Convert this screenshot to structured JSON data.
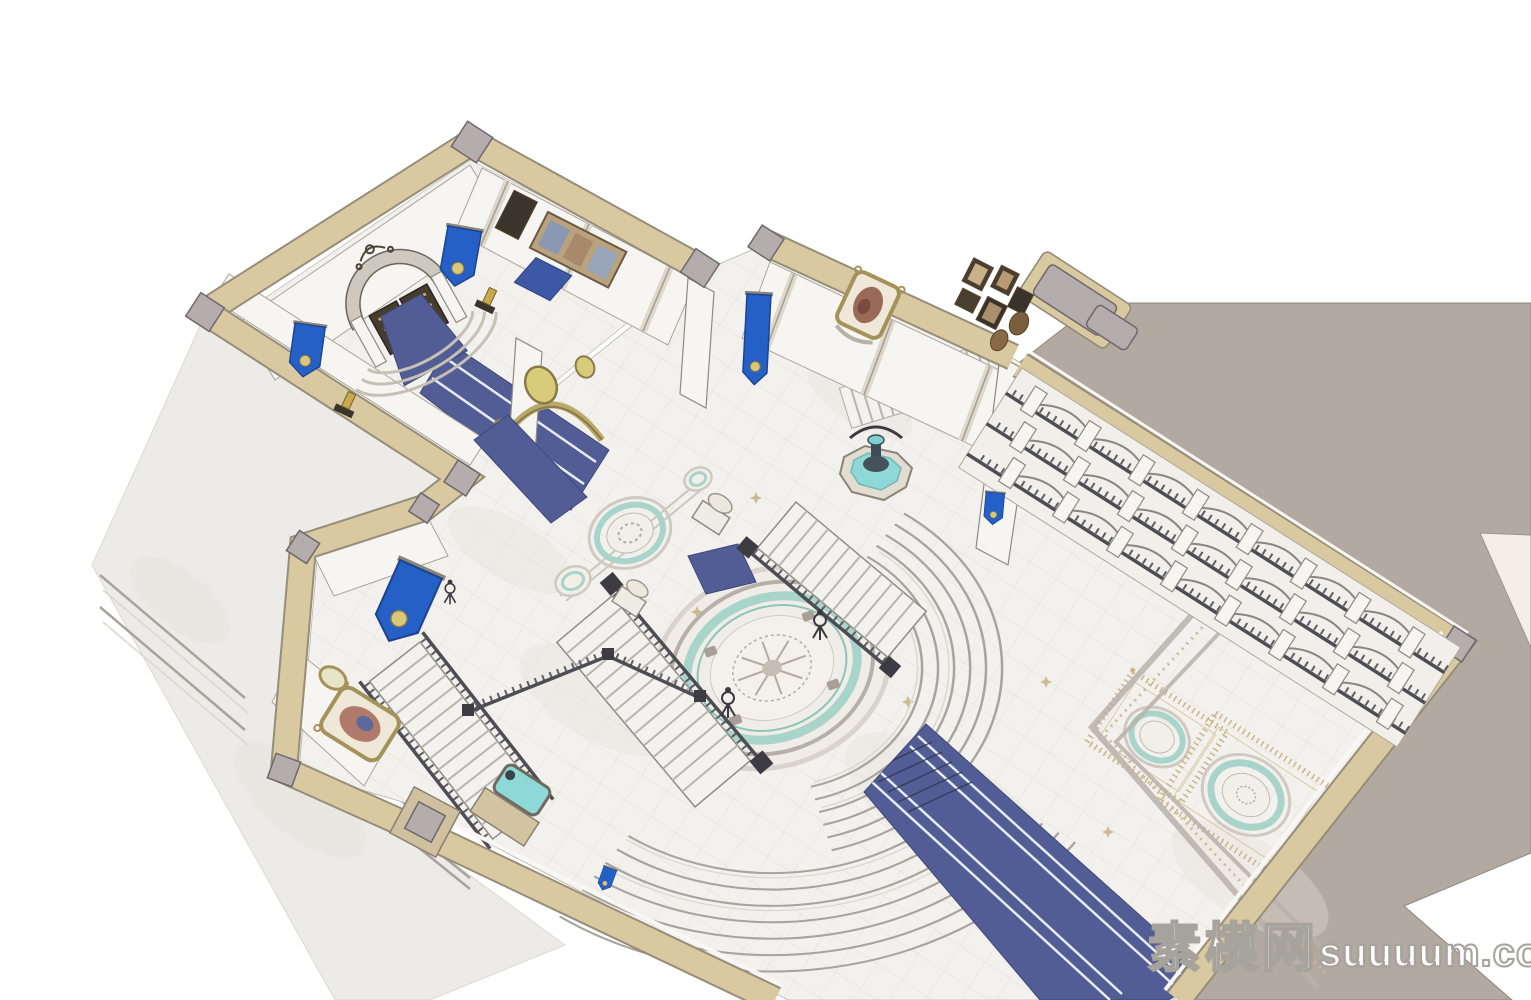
{
  "watermark": {
    "cjk": "素模网",
    "latin": "suuuum.com"
  },
  "palette": {
    "background": "#ffffff",
    "wall_cap_beige": "#d8c9a0",
    "wall_white": "#f7f5f1",
    "exterior_slab_taupe": "#b2a9a1",
    "exterior_slab_cream": "#f3efe6",
    "floor_marble": "#f3f1ed",
    "floor_exterior": "#edebe7",
    "tile_line": "#dbd7d1",
    "carpet_blue": "#535d95",
    "banner_blue": "#2560c6",
    "fountain_water_teal": "#8fd8d8",
    "medallion_teal_ring": "#a9d4c9",
    "stone_gray": "#b5adad",
    "gold_ornament": "#c9b36a",
    "bronze_door": "#463d2f",
    "glass_pale_blue": "#cfe0e8"
  },
  "scene": {
    "type": "3d-architectural-render",
    "style": "SketchUp-style isometric cutaway, roofless top-down interior view",
    "subject": "European classical palace / hotel grand lobby interior model",
    "rooms": [
      "entry-vestibule",
      "gallery-corridor",
      "grand-stair-hall",
      "portrait-room",
      "arcade-wing"
    ],
    "features": [
      "arched-bronze-double-door",
      "blue-wall-banners-with-crests",
      "blue-runner-carpets",
      "circular-mosaic-floor-medallion",
      "twin-curved-staircases",
      "three-tier-arcade-galleries",
      "teal-water-fountains",
      "framed-paintings-gallery",
      "curved-marble-steps",
      "diamond-floor-panels"
    ]
  }
}
